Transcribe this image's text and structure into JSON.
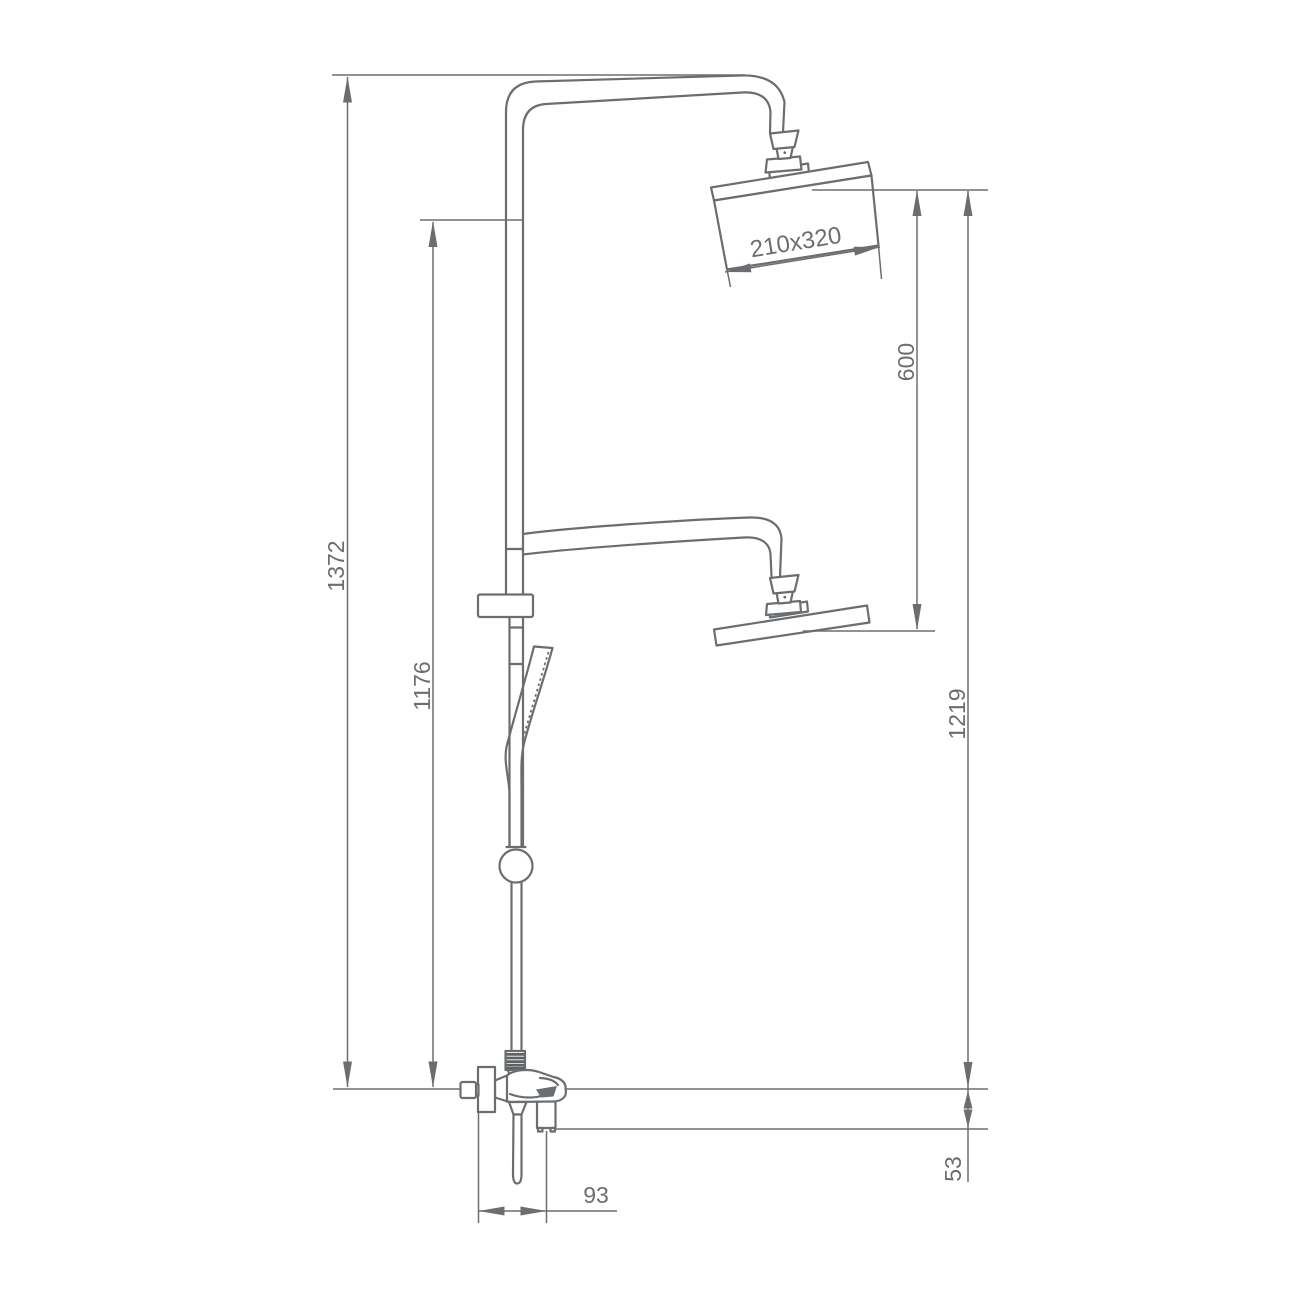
{
  "drawing": {
    "description": "Technical line drawing of a shower column with overhead rain shower head, lower shower head, hand shower on slide bar and wall-mounted mixer with spout, annotated with dimensions",
    "line_color": "#6b6e71",
    "background_color": "#ffffff",
    "dimensions": {
      "overall_height": "1372",
      "riser_height": "1176",
      "overhead_shower_size": "210x320",
      "overhead_to_lower_head": "600",
      "overhead_to_mounting_line": "1219",
      "mounting_line_to_spout": "53",
      "spout_reach": "93"
    }
  }
}
